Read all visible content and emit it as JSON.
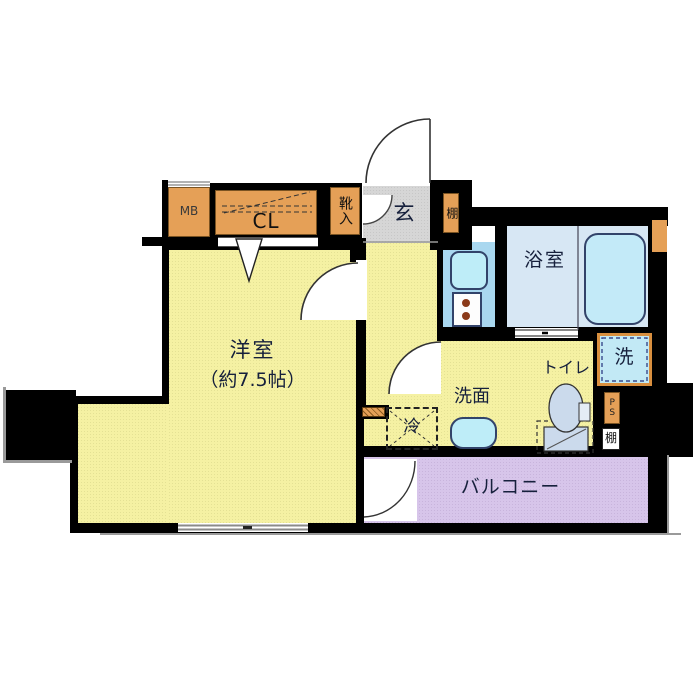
{
  "floor_plan": {
    "rooms": {
      "main_room": {
        "name": "洋室",
        "size": "（約7.5帖）"
      },
      "entrance": {
        "name": "玄"
      },
      "bathroom": {
        "name": "浴室"
      },
      "washroom": {
        "name": "洗面"
      },
      "toilet": {
        "name": "トイレ"
      },
      "balcony": {
        "name": "バルコニー"
      }
    },
    "fixtures": {
      "meter_box": "MB",
      "closet": "CL",
      "shoe_cabinet": "靴入",
      "entrance_shelf": "棚",
      "refrigerator_space": "冷",
      "washing_machine": "洗",
      "pipe_space": "PS",
      "utility_shelf": "棚"
    },
    "colors": {
      "wall": "#000000",
      "room_yellow": "#f5f1a3",
      "entrance_gray": "#d6d6d6",
      "balcony_purple": "#d7c5ea",
      "bathroom_blue": "#d7e7f4",
      "kitchen_blue": "#a9d7ef",
      "fixture_cyan": "#beedf8",
      "cabinet_orange": "#e5a057"
    }
  }
}
